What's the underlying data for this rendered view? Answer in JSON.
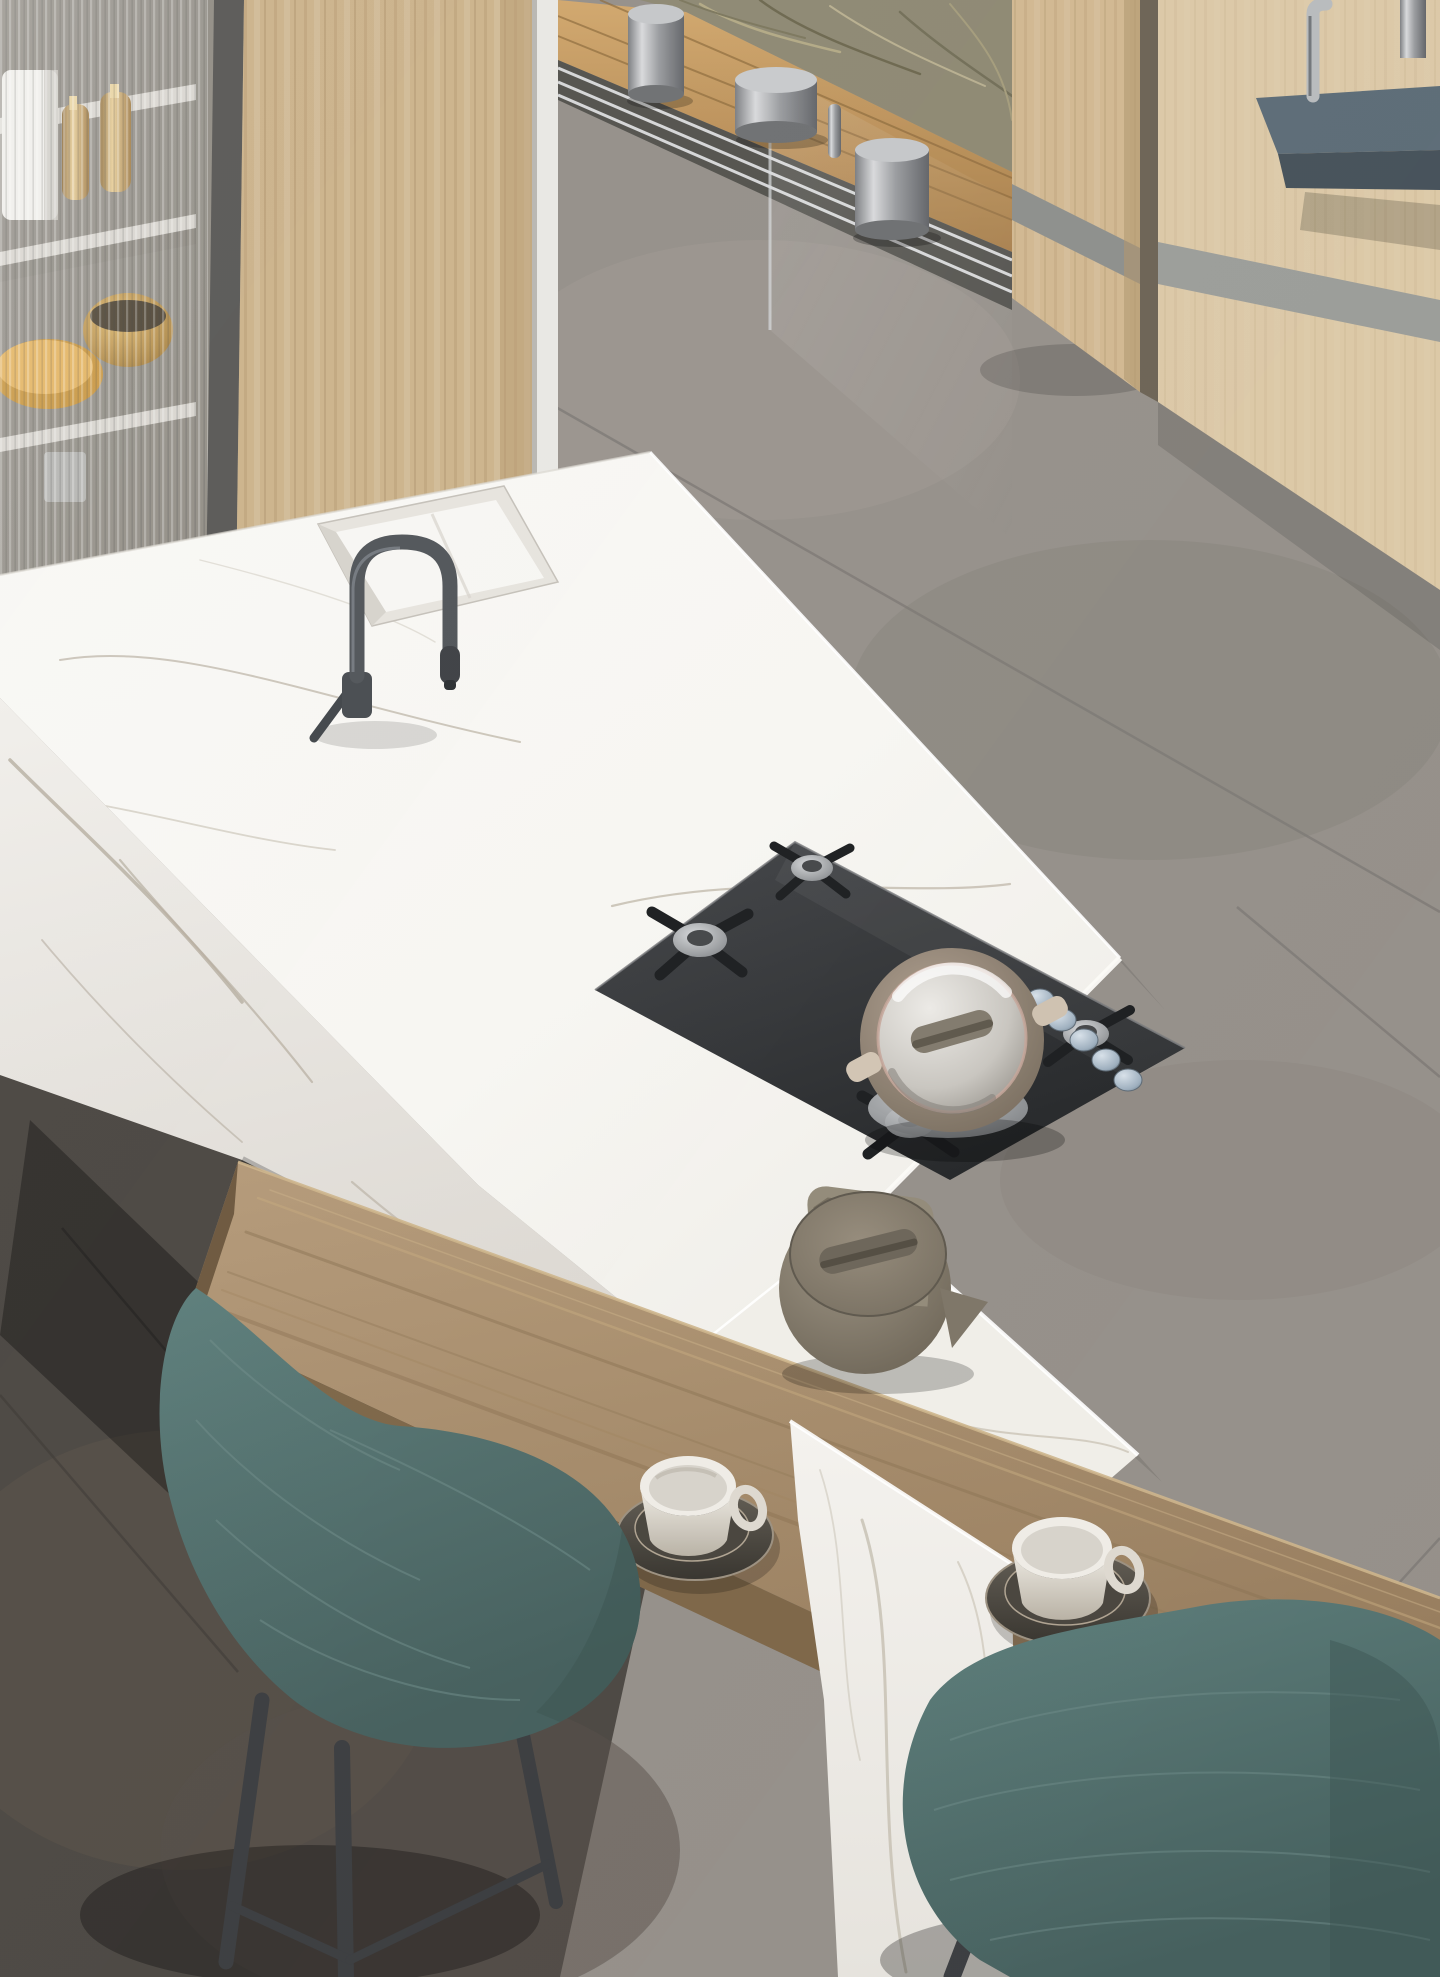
{
  "meta": {
    "kind": "photorealistic interior render",
    "room": "modern kitchen with marble island",
    "burner_count": 5,
    "knob_count": 5,
    "canister_count": 3,
    "chair_count": 2,
    "cup_count": 2
  },
  "palette": {
    "floorGray": "#96918b",
    "floorDark": "#4d4944",
    "marble": "#f7f6f3",
    "marbleLow": "#f0eee8",
    "veinGray": "#c6bfb1",
    "woodCabinet": "#cdb48d",
    "woodWall": "#dcc9a7",
    "barWood": "#ab9170",
    "teal": "#567573",
    "cooktop": "#37393b",
    "steel": "#b9bcbe",
    "kettle": "#8a8173",
    "shelfBlue": "#5e6d78",
    "brass": "#c9a86a",
    "grass": "#8f8a74",
    "deck": "#c09760"
  },
  "objects": {
    "scene": "aerial view of kitchen island in marble with wooden breakfast bar",
    "floor": "large gray concrete-look floor tiles",
    "floor_dark": "dark gray floor tiles in shadowed corner",
    "display_cabinet": "fluted glass display cabinet with brass shakers, gold bowl and wooden plate",
    "wood_cabinet": "light oak tall cabinet panel",
    "door_post": "white sliding-door frame post",
    "sliding_door": "open sliding glass wall with floor track",
    "deck": "outdoor wooden deck boards",
    "grass": "dry ornamental grasses outside",
    "canisters": "three stainless steel cylinders along the door track",
    "wood_column": "light wood pillar with gray inlay stripe",
    "wood_wall": "light wood wall with gray stripe, blue-gray shelf and steel faucet",
    "island": "white calacatta marble island volume",
    "island_top": "marble countertop with faint gray veining",
    "sink": "integrated white marble sink basin",
    "faucet": "gunmetal gray semi-professional gooseneck faucet",
    "cooktop": "black five-burner gas hob with cast-iron grates",
    "pot": "taupe casserole with glass lid on the hob",
    "knobs": "five steel-blue control knobs on hob edge",
    "kettle": "olive-taupe kettle with square loop handle",
    "bar": "oak breakfast bar slab running along the island",
    "cup1": "white cup on dark stacked saucers",
    "cup2": "white cup on dark stacked saucers",
    "chair1": "teal upholstered chair with dark wood legs",
    "chair2": "teal upholstered chair with dark wood legs"
  }
}
